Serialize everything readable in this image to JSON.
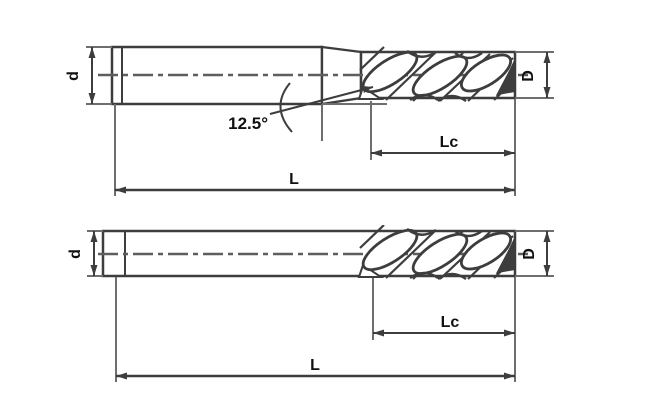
{
  "diagram": {
    "type": "technical-drawing",
    "subject": "end mill cutting tools, dimensioned side views",
    "background": "#ffffff",
    "colors": {
      "line": "#3d3d3d",
      "dim": "#6e6e6e",
      "text": "#111111"
    },
    "views": [
      {
        "name": "end-mill-with-tapered-neck",
        "labels": {
          "shank_diameter": "d",
          "cutting_diameter": "D",
          "flute_length": "Lc",
          "overall_length": "L",
          "neck_angle": "12.5°"
        }
      },
      {
        "name": "end-mill-straight-long-shank",
        "labels": {
          "shank_diameter": "d",
          "cutting_diameter": "D",
          "flute_length": "Lc",
          "overall_length": "L"
        }
      }
    ]
  }
}
